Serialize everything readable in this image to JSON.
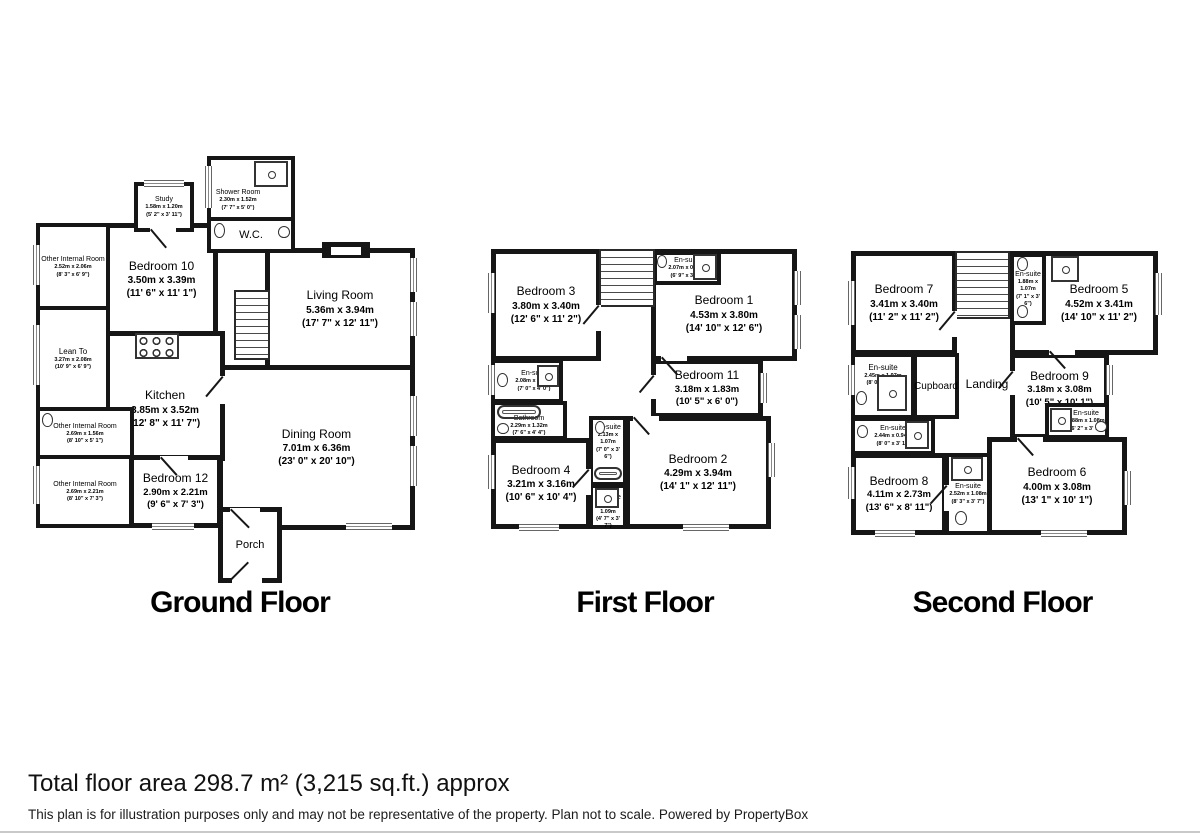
{
  "floors": [
    {
      "title": "Ground Floor",
      "rooms": [
        {
          "name": "Study",
          "metric": "1.58m x 1.20m",
          "imperial": "(5' 2\" x 3' 11\")"
        },
        {
          "name": "Shower Room",
          "metric": "2.30m x 1.52m",
          "imperial": "(7' 7\" x 5' 0\")"
        },
        {
          "name": "W.C."
        },
        {
          "name": "Other Internal Room",
          "metric": "2.52m x 2.06m",
          "imperial": "(8' 3\" x 6' 9\")"
        },
        {
          "name": "Bedroom 10",
          "metric": "3.50m x 3.39m",
          "imperial": "(11' 6\" x 11' 1\")"
        },
        {
          "name": "Living Room",
          "metric": "5.36m x 3.94m",
          "imperial": "(17' 7\" x 12' 11\")"
        },
        {
          "name": "Lean To",
          "metric": "3.27m x 2.08m",
          "imperial": "(10' 9\" x 6' 9\")"
        },
        {
          "name": "Kitchen",
          "metric": "3.85m x 3.52m",
          "imperial": "(12' 8\" x 11' 7\")"
        },
        {
          "name": "Other Internal Room",
          "metric": "2.69m x 1.56m",
          "imperial": "(8' 10\" x 5' 1\")"
        },
        {
          "name": "Other Internal Room",
          "metric": "2.69m x 2.21m",
          "imperial": "(8' 10\" x 7' 3\")"
        },
        {
          "name": "Bedroom 12",
          "metric": "2.90m x 2.21m",
          "imperial": "(9' 6\" x 7' 3\")"
        },
        {
          "name": "Dining Room",
          "metric": "7.01m x 6.36m",
          "imperial": "(23' 0\" x 20' 10\")"
        },
        {
          "name": "Porch"
        }
      ]
    },
    {
      "title": "First Floor",
      "rooms": [
        {
          "name": "Bedroom 3",
          "metric": "3.80m x 3.40m",
          "imperial": "(12' 6\" x 11' 2\")"
        },
        {
          "name": "En-suite",
          "metric": "2.07m x 0.94m",
          "imperial": "(6' 9\" x 3' 1\")"
        },
        {
          "name": "Bedroom 1",
          "metric": "4.53m x 3.80m",
          "imperial": "(14' 10\" x 12' 6\")"
        },
        {
          "name": "En-suite",
          "metric": "2.08m x 1.24m",
          "imperial": "(7' 0\" x 4' 0\")"
        },
        {
          "name": "Bathroom",
          "metric": "2.29m x 1.32m",
          "imperial": "(7' 6\" x 4' 4\")"
        },
        {
          "name": "Bedroom 11",
          "metric": "3.18m x 1.83m",
          "imperial": "(10' 5\" x 6' 0\")"
        },
        {
          "name": "En-suite",
          "metric": "2.13m x 1.07m",
          "imperial": "(7' 0\" x 3' 6\")"
        },
        {
          "name": "Bedroom 4",
          "metric": "3.21m x 3.16m",
          "imperial": "(10' 6\" x 10' 4\")"
        },
        {
          "name": "Bedroom 2",
          "metric": "4.29m x 3.94m",
          "imperial": "(14' 1\" x 12' 11\")"
        },
        {
          "name": "En-suite",
          "metric": "1.38m x 1.09m",
          "imperial": "(4' 7\" x 3' 7\")"
        }
      ]
    },
    {
      "title": "Second Floor",
      "rooms": [
        {
          "name": "Bedroom 7",
          "metric": "3.41m x 3.40m",
          "imperial": "(11' 2\" x 11' 2\")"
        },
        {
          "name": "En-suite",
          "metric": "1.88m x 1.07m",
          "imperial": "(7' 1\" x 3' 6\")"
        },
        {
          "name": "Bedroom 5",
          "metric": "4.52m x 3.41m",
          "imperial": "(14' 10\" x 11' 2\")"
        },
        {
          "name": "En-suite",
          "metric": "2.45m x 1.97m",
          "imperial": "(8' 0\" x 6' 6\")"
        },
        {
          "name": "Cupboard"
        },
        {
          "name": "Landing"
        },
        {
          "name": "Bedroom 9",
          "metric": "3.18m x 3.08m",
          "imperial": "(10' 5\" x 10' 1\")"
        },
        {
          "name": "En-suite",
          "metric": "1.88m x 1.08m",
          "imperial": "(6' 2\" x 3' 7\")"
        },
        {
          "name": "En-suite",
          "metric": "2.44m x 0.94m",
          "imperial": "(8' 0\" x 3' 1\")"
        },
        {
          "name": "Bedroom 8",
          "metric": "4.11m x 2.73m",
          "imperial": "(13' 6\" x 8' 11\")"
        },
        {
          "name": "En-suite",
          "metric": "2.52m x 1.08m",
          "imperial": "(8' 3\" x 3' 7\")"
        },
        {
          "name": "Bedroom 6",
          "metric": "4.00m x 3.08m",
          "imperial": "(13' 1\" x 10' 1\")"
        }
      ]
    }
  ],
  "footer": {
    "total_area": "Total floor area 298.7 m² (3,215 sq.ft.) approx",
    "disclaimer": "This plan is for illustration purposes only and may not be representative of the property. Plan not to scale. Powered by PropertyBox"
  },
  "colors": {
    "wall": "#161616",
    "background": "#ffffff"
  }
}
